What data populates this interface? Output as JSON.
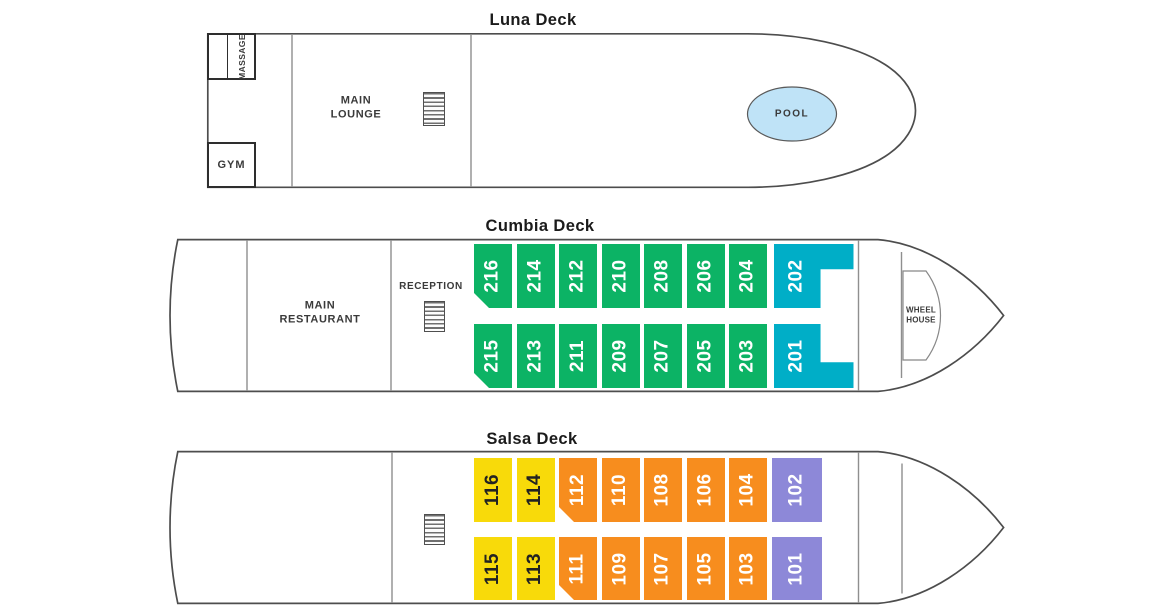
{
  "colors": {
    "hull_line": "#4d4d4d",
    "divider_line": "#8f8f8f",
    "title_text": "#1b1b1b",
    "label_text": "#3a3a3a",
    "green": "#0cb365",
    "teal": "#00aec7",
    "yellow": "#f8da0a",
    "orange": "#f78d1e",
    "purple": "#8d88d8",
    "pool_fill": "#bfe3f7",
    "cabin_text_light": "#ffffff",
    "cabin_text_dark": "#222222"
  },
  "icons": {
    "stairs": "stairs-icon"
  },
  "decks": {
    "luna": {
      "title": "Luna Deck",
      "labels": {
        "massage": "MASSAGE",
        "gym": "GYM",
        "main_lounge": [
          "MAIN",
          "LOUNGE"
        ],
        "pool": "POOL"
      }
    },
    "cumbia": {
      "title": "Cumbia Deck",
      "labels": {
        "main_restaurant": [
          "MAIN",
          "RESTAURANT"
        ],
        "reception": "RECEPTION",
        "wheel_house": [
          "WHEEL",
          "HOUSE"
        ]
      },
      "cabins_top": [
        {
          "number": "216",
          "category": "green",
          "corner_marker": true
        },
        {
          "number": "214",
          "category": "green"
        },
        {
          "number": "212",
          "category": "green"
        },
        {
          "number": "210",
          "category": "green"
        },
        {
          "number": "208",
          "category": "green"
        },
        {
          "number": "206",
          "category": "green"
        },
        {
          "number": "204",
          "category": "green"
        },
        {
          "number": "202",
          "category": "teal",
          "shape": "notch-bottom-right"
        }
      ],
      "cabins_bottom": [
        {
          "number": "215",
          "category": "green",
          "corner_marker": true
        },
        {
          "number": "213",
          "category": "green"
        },
        {
          "number": "211",
          "category": "green"
        },
        {
          "number": "209",
          "category": "green"
        },
        {
          "number": "207",
          "category": "green"
        },
        {
          "number": "205",
          "category": "green"
        },
        {
          "number": "203",
          "category": "green"
        },
        {
          "number": "201",
          "category": "teal",
          "shape": "notch-top-right"
        }
      ]
    },
    "salsa": {
      "title": "Salsa Deck",
      "cabins_top": [
        {
          "number": "116",
          "category": "yellow"
        },
        {
          "number": "114",
          "category": "yellow"
        },
        {
          "number": "112",
          "category": "orange",
          "corner_marker": true
        },
        {
          "number": "110",
          "category": "orange"
        },
        {
          "number": "108",
          "category": "orange"
        },
        {
          "number": "106",
          "category": "orange"
        },
        {
          "number": "104",
          "category": "orange"
        },
        {
          "number": "102",
          "category": "purple"
        }
      ],
      "cabins_bottom": [
        {
          "number": "115",
          "category": "yellow"
        },
        {
          "number": "113",
          "category": "yellow"
        },
        {
          "number": "111",
          "category": "orange",
          "corner_marker": true
        },
        {
          "number": "109",
          "category": "orange"
        },
        {
          "number": "107",
          "category": "orange"
        },
        {
          "number": "105",
          "category": "orange"
        },
        {
          "number": "103",
          "category": "orange"
        },
        {
          "number": "101",
          "category": "purple"
        }
      ]
    }
  }
}
